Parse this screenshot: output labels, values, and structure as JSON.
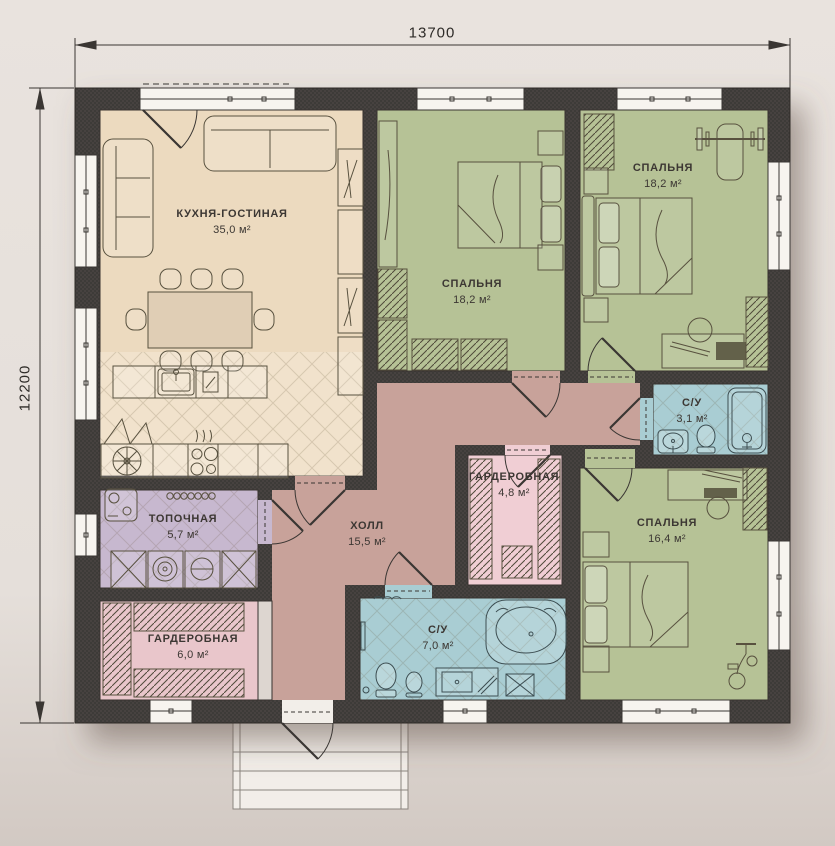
{
  "dimensions": {
    "width_label": "13700",
    "height_label": "12200"
  },
  "rooms": [
    {
      "id": "kitchen-living",
      "name": "КУХНЯ-ГОСТИНАЯ",
      "area": "35,0 м²",
      "color": "#ecdabf"
    },
    {
      "id": "bedroom-1",
      "name": "СПАЛЬНЯ",
      "area": "18,2 м²",
      "color": "#b6c296"
    },
    {
      "id": "bedroom-2",
      "name": "СПАЛЬНЯ",
      "area": "18,2 м²",
      "color": "#b6c296"
    },
    {
      "id": "bathroom-small",
      "name": "С/У",
      "area": "3,1 м²",
      "color": "#a9cdd3"
    },
    {
      "id": "bedroom-3",
      "name": "СПАЛЬНЯ",
      "area": "16,4 м²",
      "color": "#b6c296"
    },
    {
      "id": "wardrobe-center",
      "name": "ГАРДЕРОБНАЯ",
      "area": "4,8 м²",
      "color": "#f0ced4"
    },
    {
      "id": "hall",
      "name": "ХОЛЛ",
      "area": "15,5 м²",
      "color": "#c8a29a"
    },
    {
      "id": "boiler-room",
      "name": "ТОПОЧНАЯ",
      "area": "5,7 м²",
      "color": "#c7b8cf"
    },
    {
      "id": "wardrobe-left",
      "name": "ГАРДЕРОБНАЯ",
      "area": "6,0 м²",
      "color": "#e9c6cb"
    },
    {
      "id": "bathroom-big",
      "name": "С/У",
      "area": "7,0 м²",
      "color": "#a9cdd3"
    }
  ],
  "colors": {
    "wall": "#46413e",
    "window": "#f7f4ef",
    "porch": "#f2eee9",
    "background": "#e5dfda",
    "furniture_line": "#58513f",
    "label_text": "#3c3733"
  }
}
